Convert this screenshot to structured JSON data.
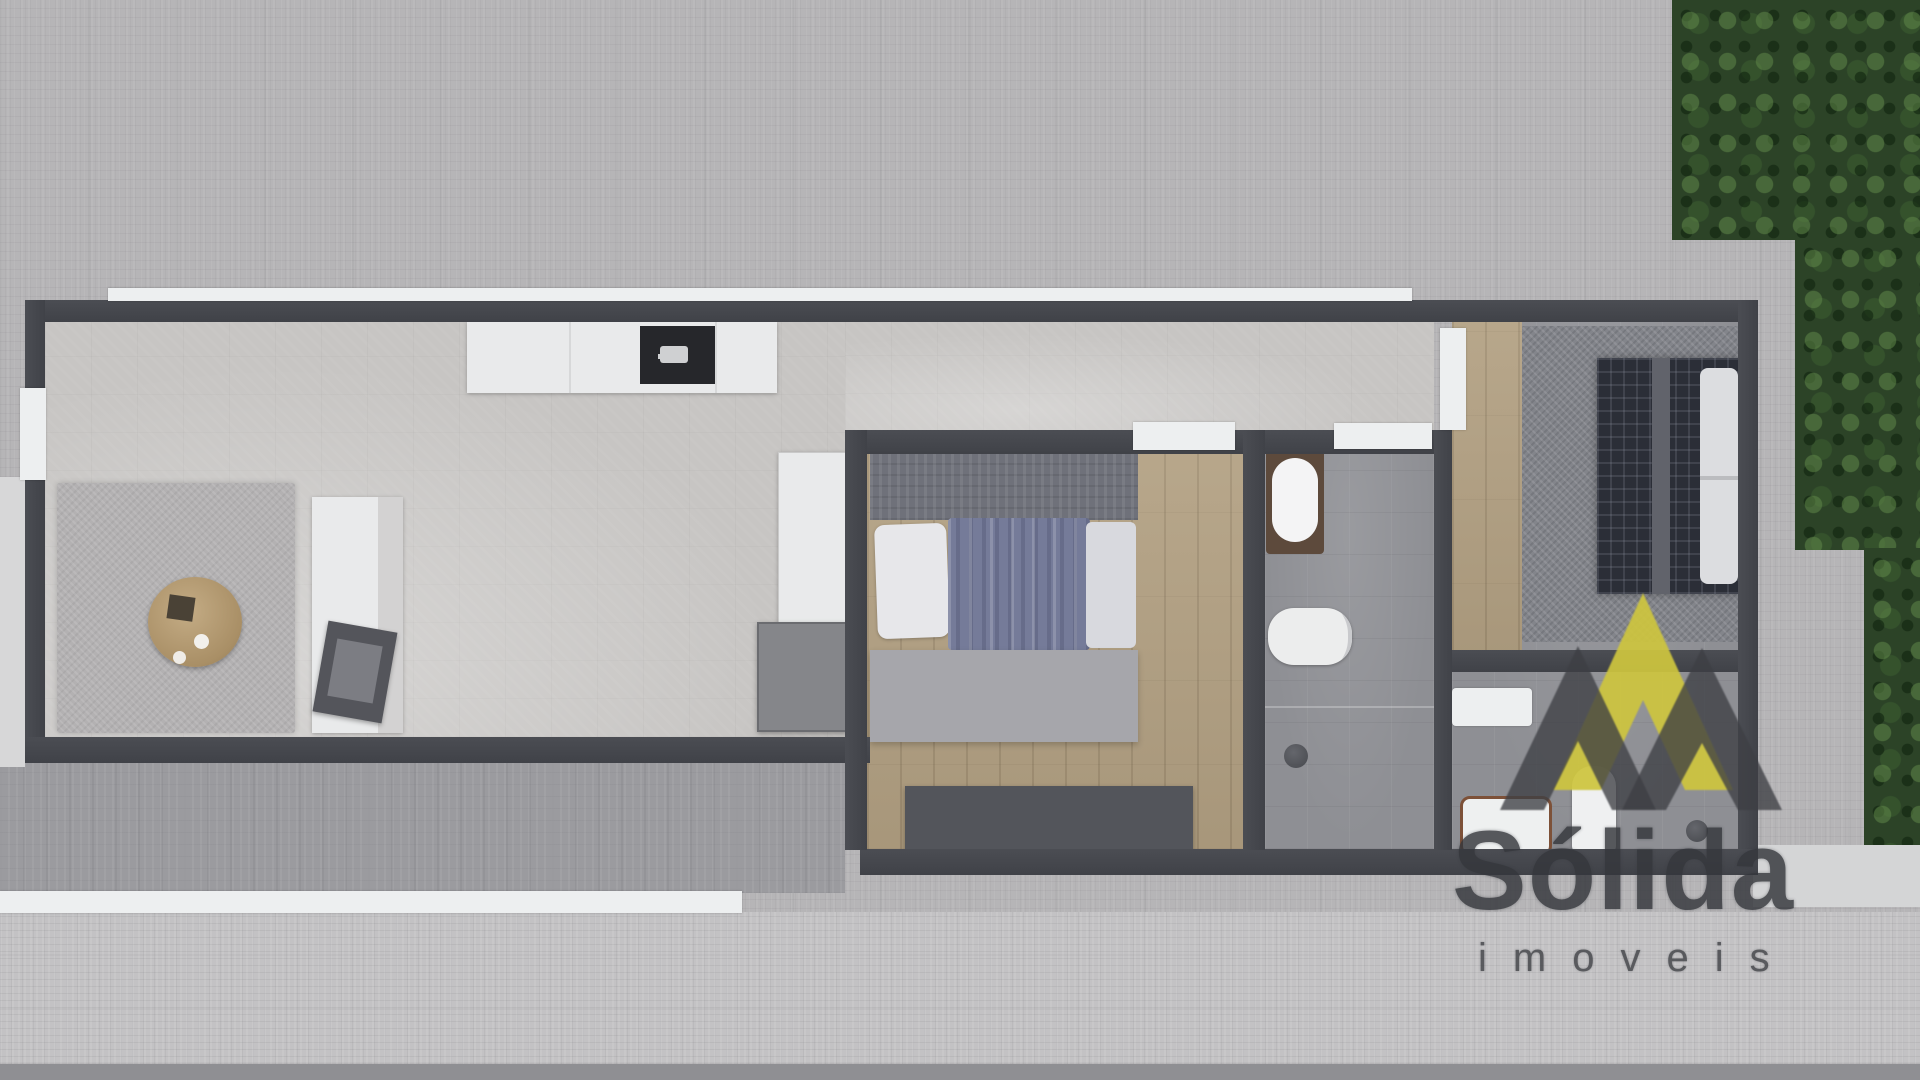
{
  "watermark": {
    "brand": "Sólida",
    "subtitle": "imoveis",
    "logo_colors": {
      "yellow": "#cdc53e",
      "dark_gray": "#3d3f44"
    },
    "text_color": "#35373c"
  },
  "scene": {
    "type": "top-down 3D rendered floor plan of a long rectangular apartment",
    "palette": {
      "paving": "#b6b5b7",
      "wall": "#45474d",
      "concrete_floor": "#c7c5c3",
      "wood_floor": "#b2a082",
      "bath_tile": "#8e8f94",
      "duvet_blue": "#757b99",
      "dark_bed": "#2b2e37",
      "foliage_green": "#2c4327"
    },
    "rooms": [
      {
        "name": "living-kitchen",
        "furniture": [
          "kitchen-counter",
          "cooktop",
          "area-rug",
          "round-coffee-table",
          "sofa",
          "armchair",
          "wardrobe",
          "cabinet"
        ]
      },
      {
        "name": "bedroom-1",
        "furniture": [
          "double-bed",
          "pillow",
          "striped-duvet",
          "foot-bench",
          "dresser"
        ]
      },
      {
        "name": "bathroom-1",
        "furniture": [
          "vanity-basin",
          "toilet"
        ]
      },
      {
        "name": "bedroom-2",
        "furniture": [
          "dark-grid-bed",
          "pillows",
          "wall-shelf"
        ]
      },
      {
        "name": "bathroom-2",
        "furniture": [
          "vanity-basin",
          "toilet",
          "shelf"
        ]
      }
    ],
    "exterior": [
      "hedge-foliage-top-right",
      "terrace-strip-bottom-left",
      "white-ledges"
    ]
  }
}
